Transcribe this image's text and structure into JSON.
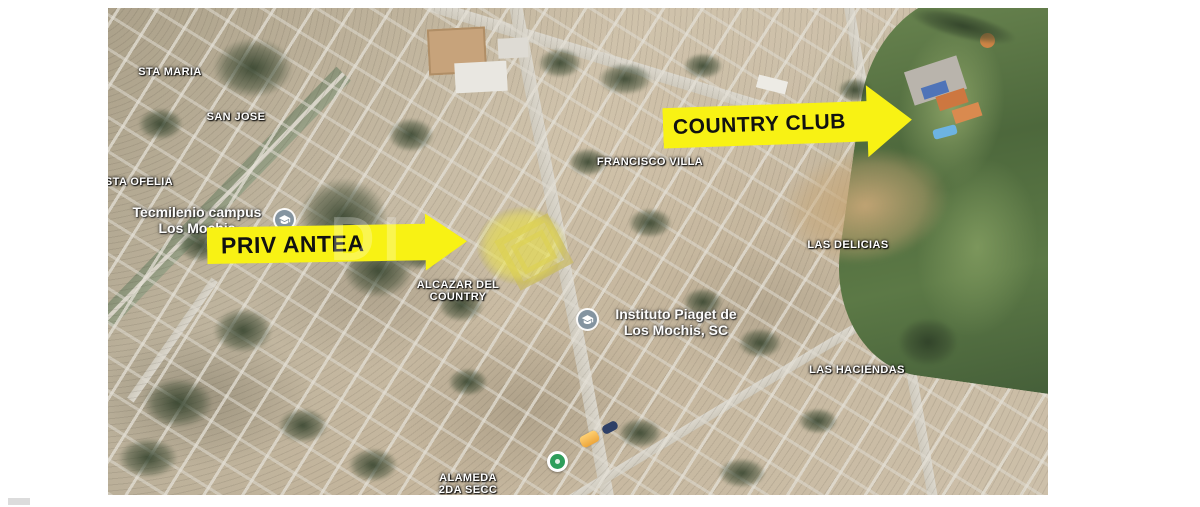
{
  "map": {
    "annotations": {
      "priv_antea": {
        "label": "PRIV ANTEA"
      },
      "country_club": {
        "label": "COUNTRY CLUB"
      }
    },
    "region_labels": {
      "sta_maria": {
        "text": "STA MARIA"
      },
      "san_jose": {
        "text": "SAN JOSE"
      },
      "sta_ofelia": {
        "text": "STA OFELIA"
      },
      "francisco_villa": {
        "text": "FRANCISCO VILLA"
      },
      "las_delicias": {
        "text": "LAS DELICIAS"
      },
      "las_haciendas": {
        "text": "LAS HACIENDAS"
      },
      "alameda": {
        "line1": "ALAMEDA",
        "line2": "2DA SECC"
      },
      "alcazar": {
        "line1": "ALCAZAR DEL",
        "line2": "COUNTRY"
      }
    },
    "poi_labels": {
      "tecmilenio": {
        "line1": "Tecmilenio campus",
        "line2": "Los Mochis"
      },
      "instituto_piaget": {
        "line1": "Instituto Piaget de",
        "line2": "Los Mochis, SC"
      }
    },
    "icons": {
      "school": "graduation-cap-icon",
      "park": "park-marker-icon"
    },
    "watermark": {
      "text": "DI"
    },
    "colors": {
      "annotation_yellow": "#f8f214",
      "annotation_text": "#111111",
      "highlight_yellow": "#e9e046",
      "label_text": "#ffffff",
      "park_marker_green": "#2e9e5b",
      "canopy_orange": "#eda63b",
      "golf_green": "#4d683c",
      "terrain_tan": "#c9baa1"
    }
  }
}
